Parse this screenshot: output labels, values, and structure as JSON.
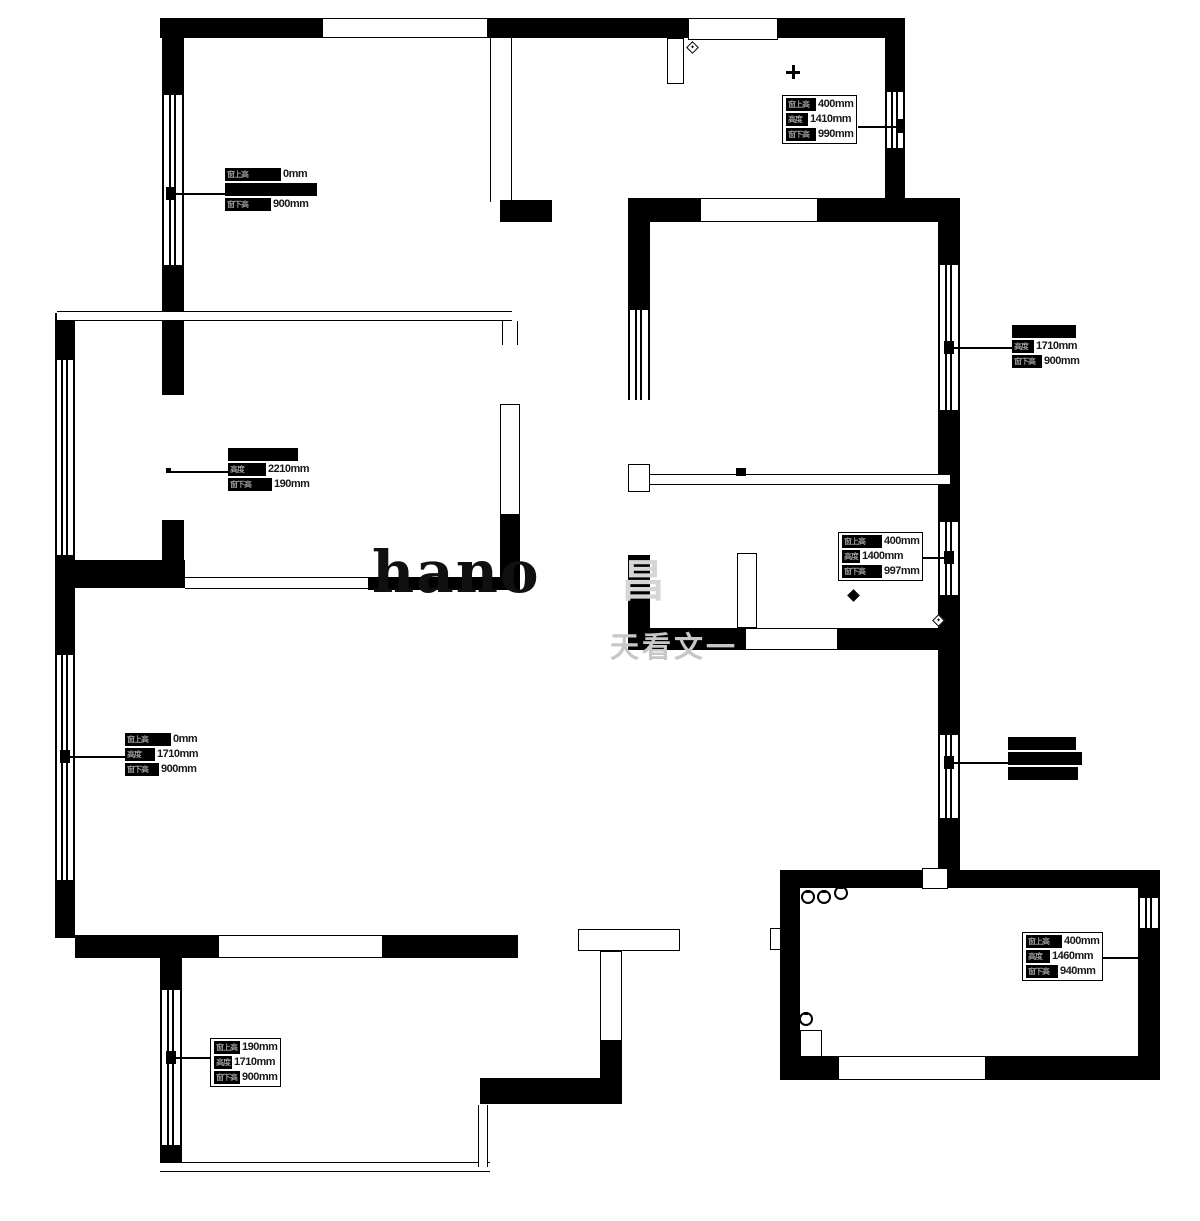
{
  "labels": {
    "top_right": {
      "rows": [
        {
          "p": "窗上高",
          "v": "400mm"
        },
        {
          "p": "高度",
          "v": "1410mm"
        },
        {
          "p": "窗下高",
          "v": "990mm"
        }
      ]
    },
    "top_left": {
      "rows": [
        {
          "p": "窗上高",
          "v": "0mm"
        },
        {
          "p": "",
          "v": ""
        },
        {
          "p": "窗下高",
          "v": "900mm"
        }
      ]
    },
    "right_upper": {
      "rows": [
        {
          "p": "",
          "v": ""
        },
        {
          "p": "高度",
          "v": "1710mm"
        },
        {
          "p": "窗下高",
          "v": "900mm"
        }
      ]
    },
    "mid_left": {
      "rows": [
        {
          "p": "",
          "v": ""
        },
        {
          "p": "高度",
          "v": "2210mm"
        },
        {
          "p": "窗下高",
          "v": "190mm"
        }
      ]
    },
    "mid_right": {
      "rows": [
        {
          "p": "窗上高",
          "v": "400mm"
        },
        {
          "p": "高度",
          "v": "1400mm"
        },
        {
          "p": "窗下高",
          "v": "997mm"
        }
      ]
    },
    "left_mid": {
      "rows": [
        {
          "p": "窗上高",
          "v": "0mm"
        },
        {
          "p": "高度",
          "v": "1710mm"
        },
        {
          "p": "窗下高",
          "v": "900mm"
        }
      ]
    },
    "right_mid": {
      "rows": [
        {
          "p": "",
          "v": ""
        },
        {
          "p": "",
          "v": ""
        },
        {
          "p": "",
          "v": ""
        }
      ]
    },
    "bottom_right": {
      "rows": [
        {
          "p": "窗上高",
          "v": "400mm"
        },
        {
          "p": "高度",
          "v": "1460mm"
        },
        {
          "p": "窗下高",
          "v": "940mm"
        }
      ]
    },
    "bottom_left": {
      "rows": [
        {
          "p": "窗上高",
          "v": "190mm"
        },
        {
          "p": "高度",
          "v": "1710mm"
        },
        {
          "p": "窗下高",
          "v": "900mm"
        }
      ]
    }
  },
  "watermark": {
    "latin": "hano",
    "block": "昌",
    "line": "天看文一"
  }
}
